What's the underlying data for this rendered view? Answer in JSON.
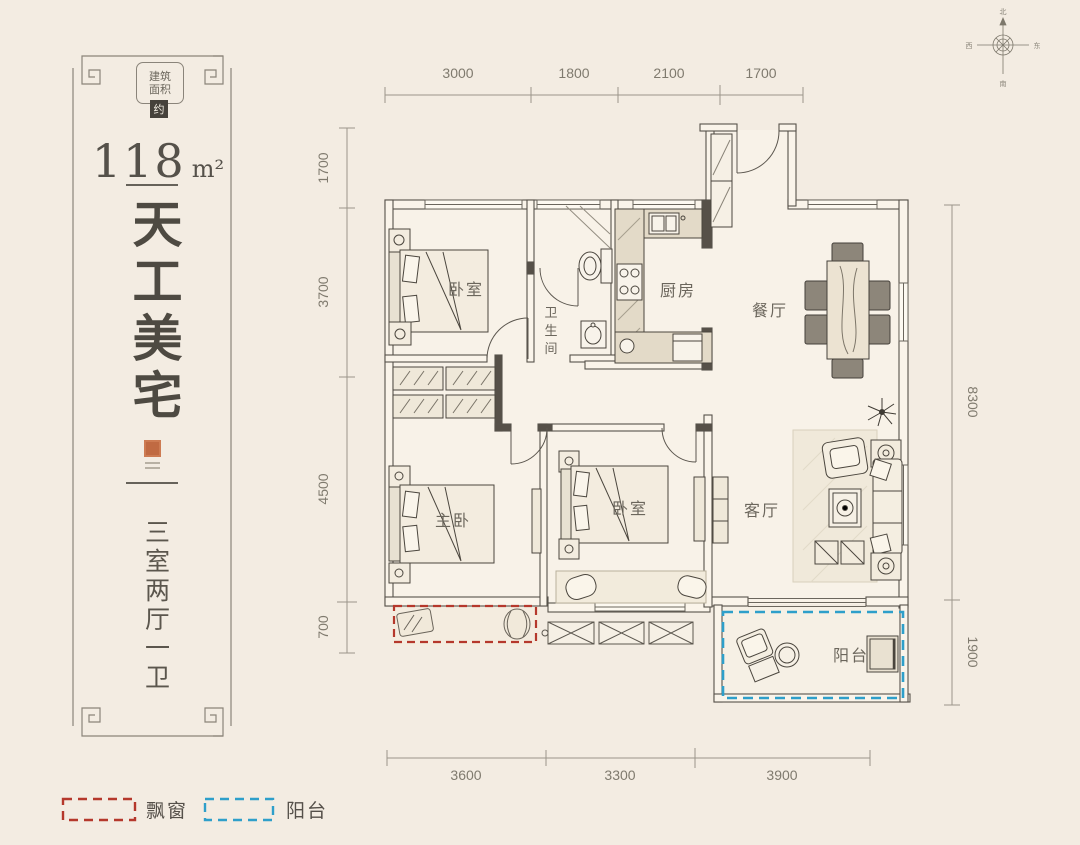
{
  "panel": {
    "badge_line1": "建筑",
    "badge_line2": "面积",
    "badge_approx": "约",
    "area_value": "118",
    "area_unit": "m²",
    "title_chars": [
      "天",
      "工",
      "美",
      "宅"
    ],
    "subtitle_chars": [
      "三",
      "室",
      "两",
      "厅",
      "一",
      "卫"
    ]
  },
  "dimensions": {
    "top": [
      "3000",
      "1800",
      "2100",
      "1700"
    ],
    "left": [
      "1700",
      "3700",
      "4500",
      "700"
    ],
    "right": [
      "8300",
      "1900"
    ],
    "bottom": [
      "3600",
      "3300",
      "3900"
    ]
  },
  "rooms": {
    "bedroom_top": "卧室",
    "bathroom_chars": [
      "卫",
      "生",
      "间"
    ],
    "kitchen": "厨房",
    "dining": "餐厅",
    "master_bedroom": "主卧",
    "bedroom_middle": "卧室",
    "living": "客厅",
    "balcony": "阳台"
  },
  "legend": {
    "bay_window_label": "飘窗",
    "balcony_label": "阳台",
    "bay_window_color": "#b5382c",
    "balcony_color": "#2e9fca"
  },
  "compass": {
    "north": "北",
    "south": "南",
    "east": "东",
    "west": "西"
  }
}
